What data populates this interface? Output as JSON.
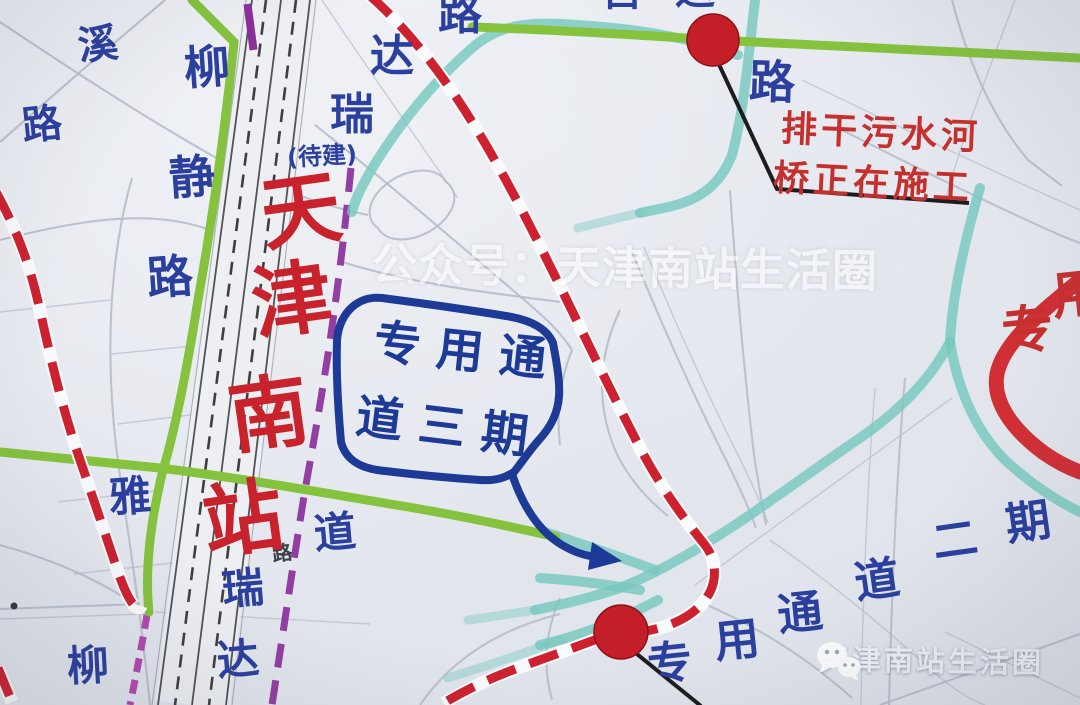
{
  "colors": {
    "background": "#e5e8ee",
    "minor_road": "#b7bdc9",
    "railway": "#2b2b30",
    "green_road": "#85c23e",
    "teal_river": "#74c8be",
    "red_dashed_road": "#cd2130",
    "red_solid_road": "#d0252c",
    "red_circle": "#c41f28",
    "purple_metro": "#8b2f9b",
    "magenta_metro": "#b03fae",
    "blue_label": "#2b3f9e",
    "callout_blue": "#1c3a96",
    "station_red": "#c8232c",
    "annotation_red": "#c5302e",
    "leader_black": "#1d1d1f"
  },
  "station": {
    "name": "天津南站",
    "chars": [
      "天",
      "津",
      "南",
      "站"
    ]
  },
  "road_labels": {
    "liu_top": "柳",
    "jing": "静",
    "lu_jing": "路",
    "xi": "溪",
    "lu_xi": "路",
    "lu_top": "路",
    "da_top": "达",
    "rui_top": "瑞",
    "pending": "(待建)",
    "dao_mid": "道",
    "rui_mid": "瑞",
    "da_mid": "达",
    "ya": "雅",
    "liu_bottom": "柳",
    "lu_right": "路",
    "lu_small": "路"
  },
  "top_partial": {
    "char1": "自",
    "char2": "运"
  },
  "phase3_callout": {
    "line1": "专用通",
    "line2": "道三期"
  },
  "phase2_label": {
    "chars": [
      "专",
      "用",
      "通",
      "道",
      "二",
      "期"
    ]
  },
  "phase1_edge": {
    "char1": "专",
    "char2": "用"
  },
  "construction_note": {
    "line1": "排干污水河",
    "line2": "桥正在施工"
  },
  "watermark_center": "公众号：天津南站生活圈",
  "watermark_corner": "天津南站生活圈"
}
